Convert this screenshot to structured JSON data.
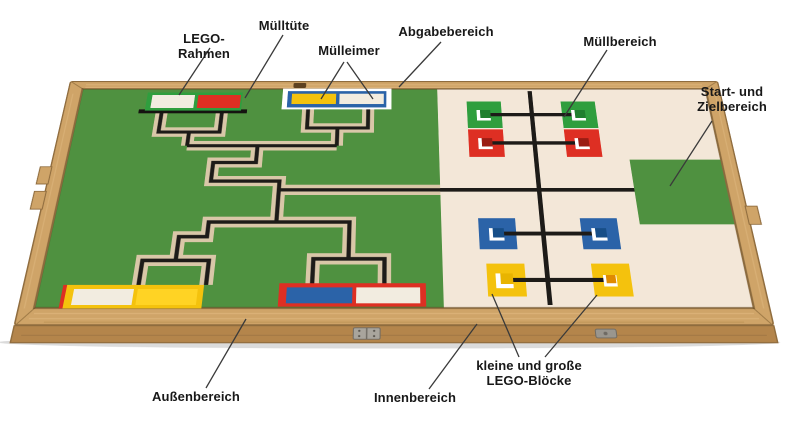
{
  "annotations": {
    "labels": [
      {
        "id": "lego-rahmen",
        "text": "LEGO-Rahmen"
      },
      {
        "id": "muelltuete",
        "text": "Mülltüte"
      },
      {
        "id": "muelleimer",
        "text": "Mülleimer"
      },
      {
        "id": "abgabebereich",
        "text": "Abgabebereich"
      },
      {
        "id": "muellbereich",
        "text": "Müllbereich"
      },
      {
        "id": "start-ziel",
        "text": "Start- und Zielbereich"
      },
      {
        "id": "aussenbereich",
        "text": "Außenbereich"
      },
      {
        "id": "innenbereich",
        "text": "Innenbereich"
      },
      {
        "id": "lego-bloecke",
        "text": "kleine und große LEGO-Blöcke"
      }
    ]
  },
  "board": {
    "left_field": "Außenbereich",
    "right_field": "Innenbereich",
    "frames": [
      {
        "position": "top-left",
        "frame_color": "green",
        "plates": [
          "white",
          "red"
        ]
      },
      {
        "position": "top-right",
        "frame_color": "blue",
        "outline": "white",
        "plates": [
          "yellow",
          "white"
        ]
      },
      {
        "position": "bottom-left",
        "frame_color": "yellow",
        "plates": [
          "white",
          "yellow"
        ]
      },
      {
        "position": "bottom-right",
        "frame_color": "red",
        "plates": [
          "blue",
          "white"
        ]
      }
    ],
    "marker_rows": [
      {
        "row": 1,
        "color": "green",
        "squares": 2,
        "blocks_per_square": 1
      },
      {
        "row": 2,
        "color": "red",
        "squares": 2,
        "blocks_per_square": 1
      },
      {
        "row": 3,
        "color": "blue",
        "squares": 2,
        "blocks_per_square": 1
      },
      {
        "row": 4,
        "color": "yellow",
        "squares": 2,
        "blocks_per_square": 1
      }
    ]
  },
  "colors": {
    "wood": "#cfa468",
    "wood-front": "#b4854b",
    "wood-edge": "#8f6c3e",
    "wood-light": "#e3bc82",
    "board-green": "#4f9140",
    "field-cream": "#f3e7d8",
    "path-beige": "#d9c7a8",
    "line-black": "#1d1b18",
    "lego-red": "#de2f23",
    "lego-yellow": "#f4c20d",
    "lego-blue": "#2b63a8",
    "lego-green": "#2f9e3e",
    "lego-white": "#f2ece0",
    "block-green": "#1f7f2e",
    "block-red": "#9b1d14",
    "block-blue": "#174e88",
    "block-orange": "#e08b00",
    "pointer": "#3a3a3a"
  }
}
